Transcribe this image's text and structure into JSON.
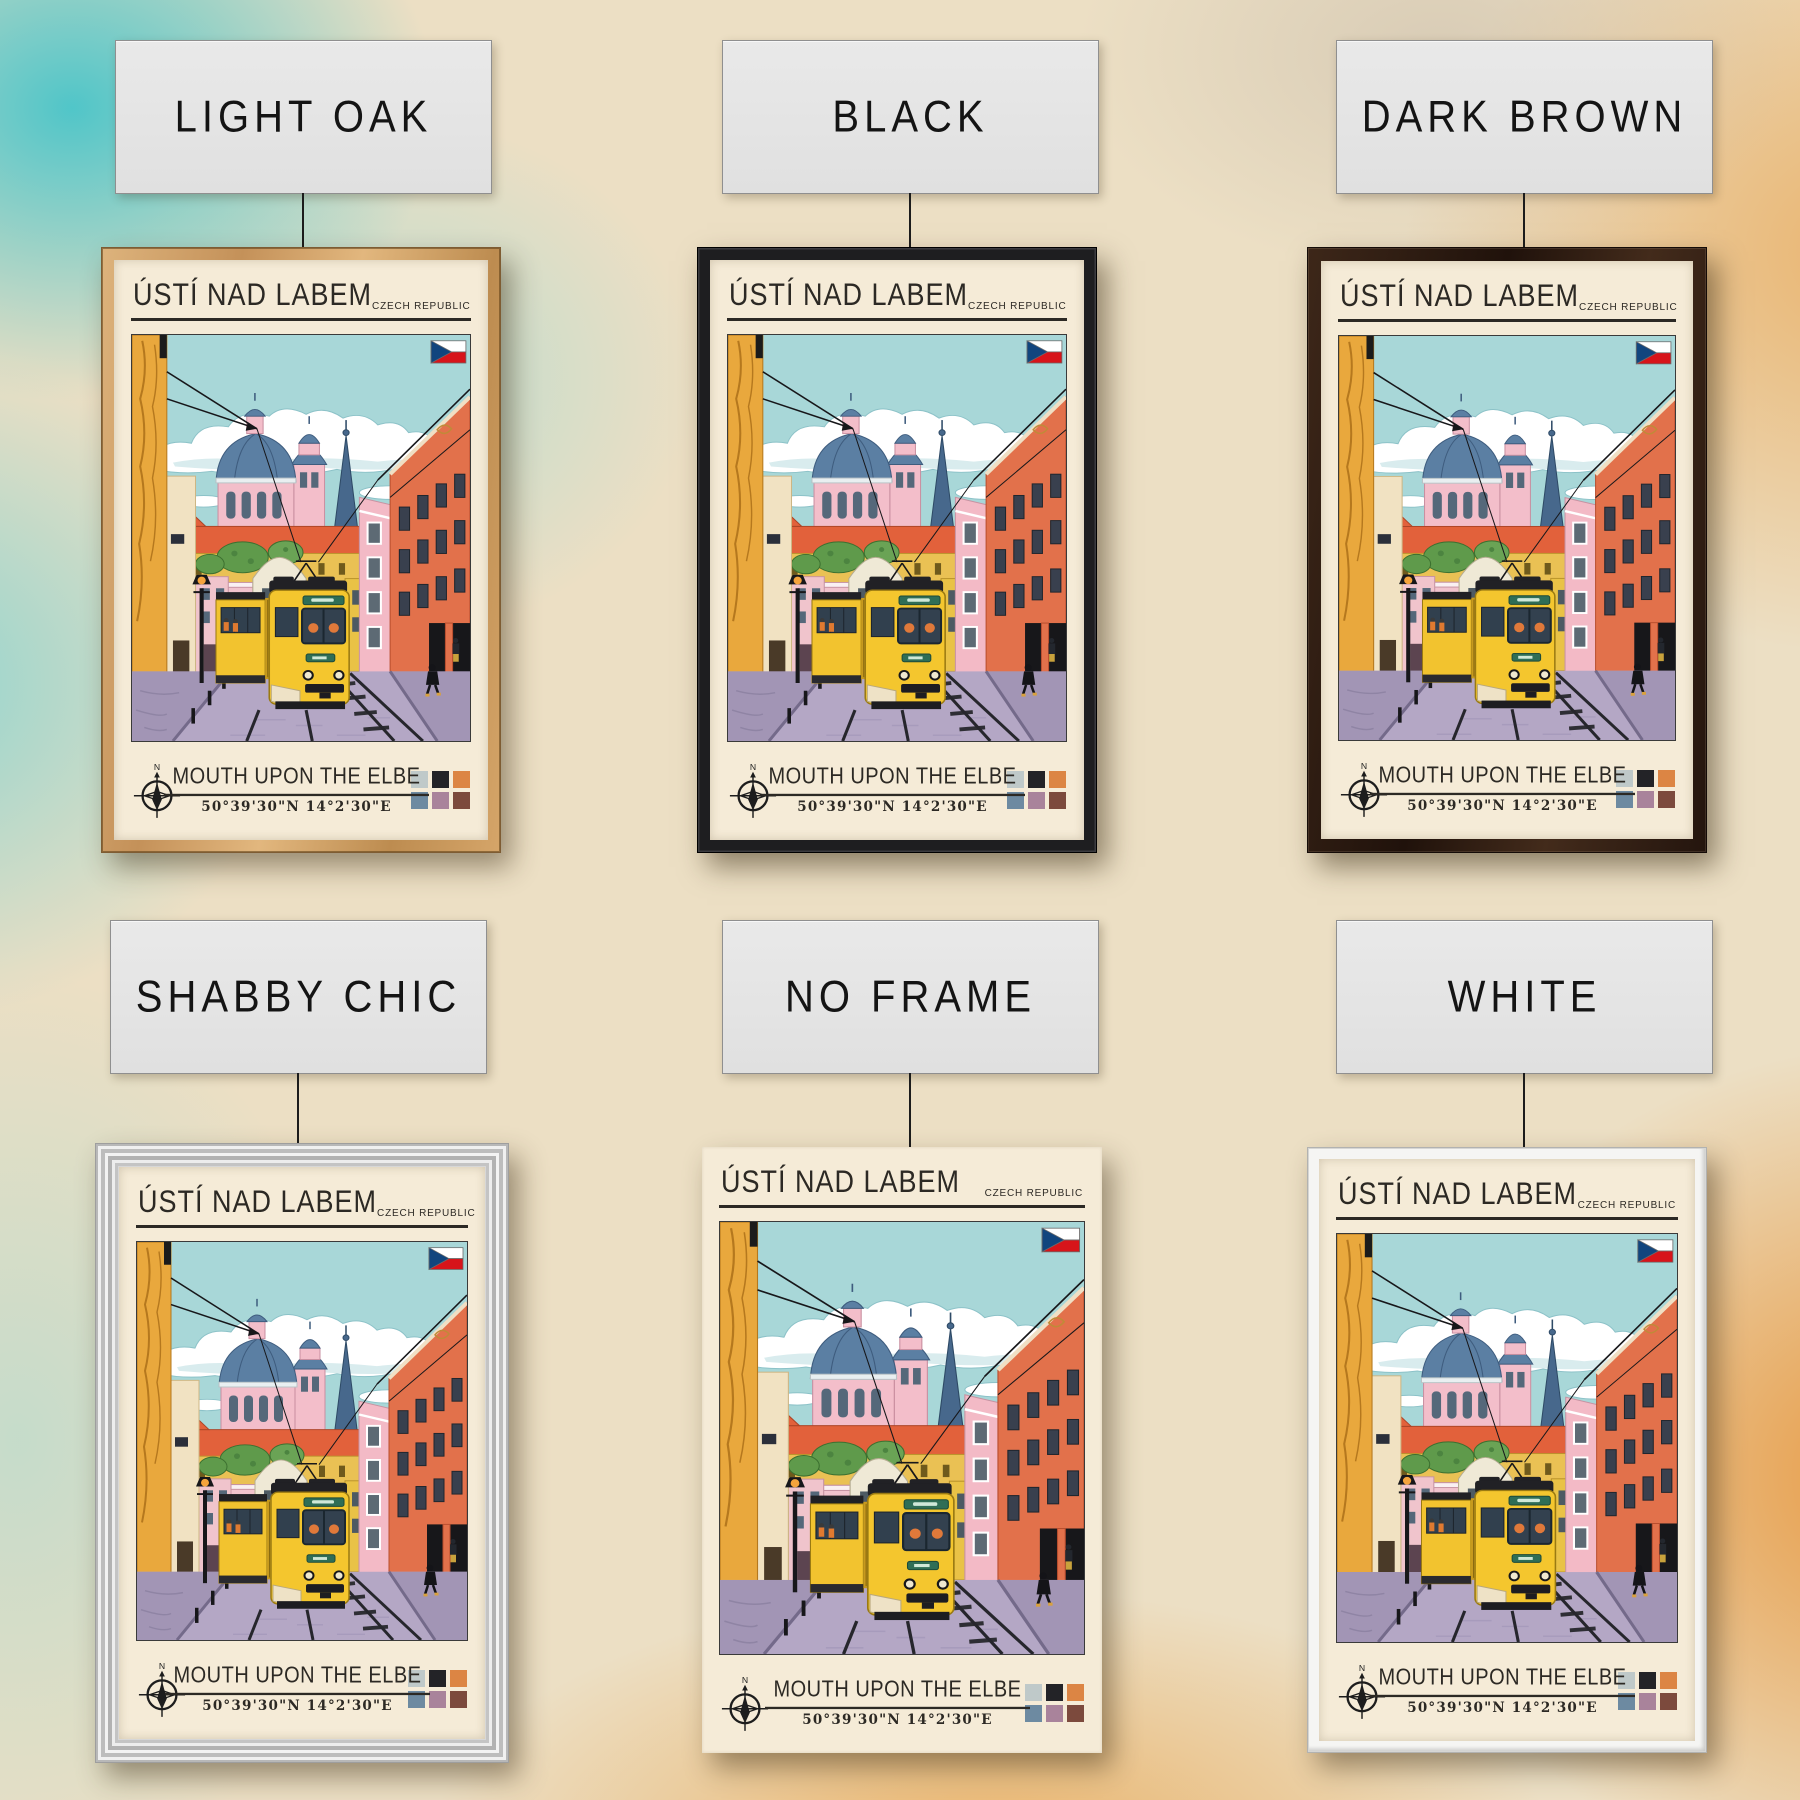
{
  "product": {
    "name": "Ústí nad Labem travel poster frame options"
  },
  "frames": [
    {
      "id": "light-oak",
      "label": "LIGHT OAK",
      "color": "#d2a368"
    },
    {
      "id": "black",
      "label": "BLACK",
      "color": "#1f1f22"
    },
    {
      "id": "dark-brown",
      "label": "DARK BROWN",
      "color": "#2d1c12"
    },
    {
      "id": "shabby-chic",
      "label": "SHABBY CHIC",
      "color": "#dcdcdc"
    },
    {
      "id": "no-frame",
      "label": "NO FRAME",
      "color": "none"
    },
    {
      "id": "white",
      "label": "WHITE",
      "color": "#f5f5f3"
    }
  ],
  "poster": {
    "title": "ÚSTÍ NAD LABEM",
    "country": "CZECH REPUBLIC",
    "subtitle": "MOUTH UPON THE ELBE",
    "coordinates": "50°39'30\"N 14°2'30\"E",
    "compass_label": "N",
    "palette": [
      "#bfc9c9",
      "#232327",
      "#dc8544",
      "#6d8aa1",
      "#a9839b",
      "#7c4a3d"
    ],
    "background_color": "#f5ebd7",
    "flag_colors": {
      "white": "#ffffff",
      "red": "#d7141a",
      "blue": "#11457e"
    }
  }
}
